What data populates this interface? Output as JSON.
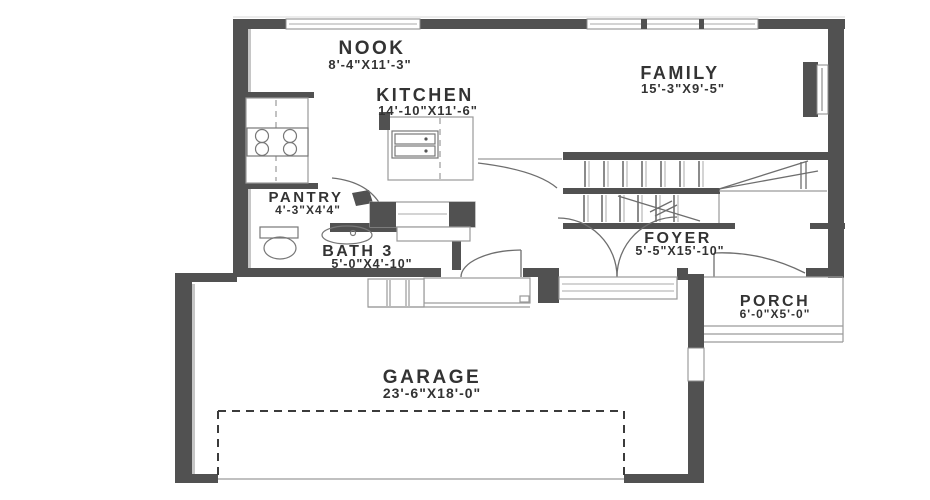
{
  "plan": {
    "type": "first-floor-plan",
    "rooms": {
      "nook": {
        "name": "NOOK",
        "dims": "8'-4\"X11'-3\""
      },
      "kitchen": {
        "name": "KITCHEN",
        "dims": "14'-10\"X11'-6\""
      },
      "family": {
        "name": "FAMILY",
        "dims": "15'-3\"X9'-5\""
      },
      "pantry": {
        "name": "PANTRY",
        "dims": "4'-3\"X4'4\""
      },
      "bath3": {
        "name": "BATH 3",
        "dims": "5'-0\"X4'-10\""
      },
      "foyer": {
        "name": "FOYER",
        "dims": "5'-5\"X15'-10\""
      },
      "porch": {
        "name": "PORCH",
        "dims": "6'-0\"X5'-0\""
      },
      "garage": {
        "name": "GARAGE",
        "dims": "23'-6\"X18'-0\""
      }
    },
    "colors": {
      "wall": "#515151",
      "line": "#9a9a9a",
      "text": "#333333",
      "background": "#ffffff"
    }
  }
}
